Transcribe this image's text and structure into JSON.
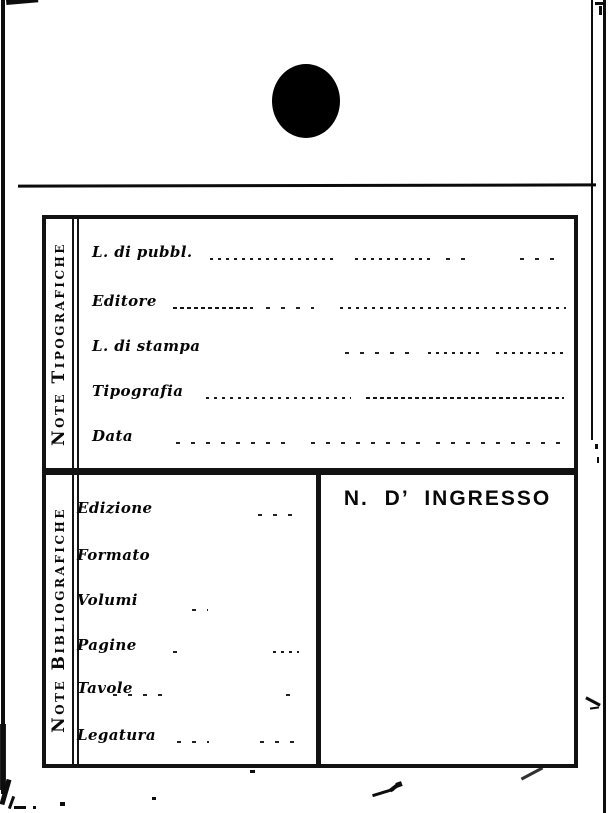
{
  "colors": {
    "ink": "#0d0d0d",
    "paper": "#ffffff"
  },
  "marks": {
    "hole_punch": "filled-circle",
    "header_rule": "horizontal-line",
    "pen_flourish": "diagonal-pen-strokes"
  },
  "card": {
    "sections": [
      {
        "title": "Note Tipografiche",
        "fields": [
          {
            "label": "L. di pubbl.",
            "value": ""
          },
          {
            "label": "Editore",
            "value": ""
          },
          {
            "label": "L. di stampa",
            "value": ""
          },
          {
            "label": "Tipografia",
            "value": ""
          },
          {
            "label": "Data",
            "value": ""
          }
        ]
      },
      {
        "title": "Note Bibliografiche",
        "fields": [
          {
            "label": "Edizione",
            "value": ""
          },
          {
            "label": "Formato",
            "value": ""
          },
          {
            "label": "Volumi",
            "value": ""
          },
          {
            "label": "Pagine",
            "value": ""
          },
          {
            "label": "Tavole",
            "value": ""
          },
          {
            "label": "Legatura",
            "value": ""
          }
        ],
        "ingresso": {
          "label": "N. D’ INGRESSO",
          "value": ""
        }
      }
    ]
  }
}
